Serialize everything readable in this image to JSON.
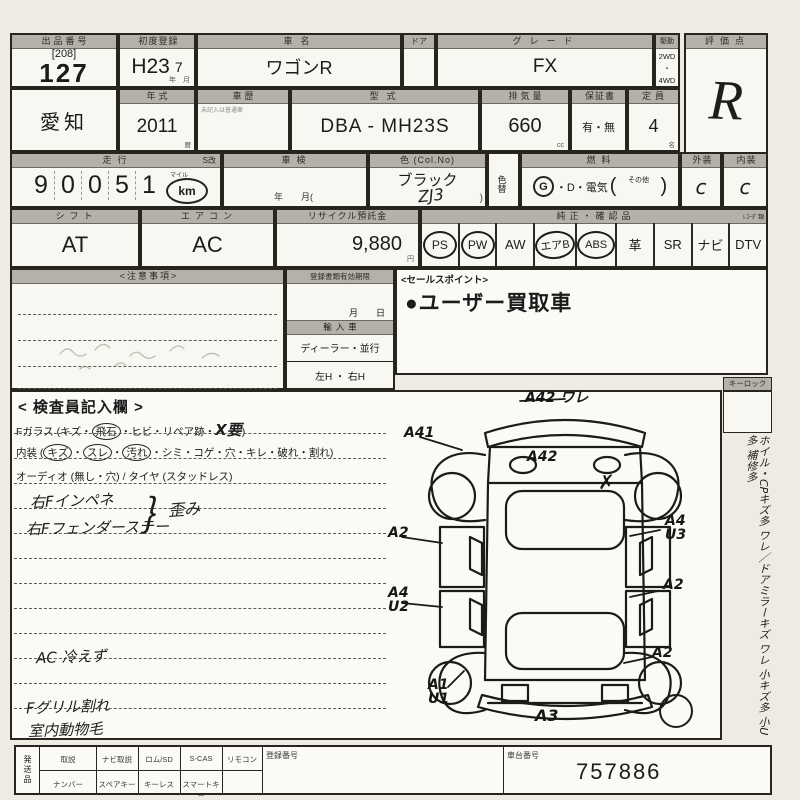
{
  "row1": {
    "lot_header": "出品番号",
    "lot_bracket": "[208]",
    "lot_number": "127",
    "first_reg_header": "初度登録",
    "first_reg": "H23",
    "first_reg_month": "7",
    "first_reg_units": "年　月",
    "car_name_header": "車名",
    "car_name": "ワゴンR",
    "door_header": "ドア",
    "grade_header": "グレード",
    "grade": "FX",
    "drive_header": "駆動",
    "drive_top": "2WD",
    "drive_dot": "・",
    "drive_bottom": "4WD",
    "score_header": "評価点",
    "score": "R"
  },
  "row2": {
    "prefecture": "愛知",
    "year_header": "年式",
    "year": "2011",
    "year_unit": "暦",
    "history_header": "車歴",
    "history_note": "未記入は普通車",
    "model_header": "型式",
    "model": "DBA - MH23S",
    "displacement_header": "排気量",
    "displacement": "660",
    "displacement_unit": "cc",
    "warranty_header": "保証書",
    "warranty": "有・無",
    "capacity_header": "定員",
    "capacity": "4",
    "capacity_unit": "名"
  },
  "row3": {
    "mileage_header": "走行",
    "s_header": "S改",
    "mileage_digits": [
      "9",
      "0",
      "0",
      "5",
      "1"
    ],
    "mileage_mile_label": "マイル",
    "mileage_unit": "km",
    "inspection_header": "車検",
    "inspection_units": "年　　月(",
    "color_header": "色 (Col.No)",
    "color": "ブラック",
    "color_code": "ZJ3",
    "color_paren": ")",
    "color_change_header": "色替",
    "fuel_header": "燃料",
    "fuel_g": "G",
    "fuel_rest": "・D・電気",
    "fuel_paren_open": "(",
    "fuel_other": "その他",
    "fuel_paren_close": ")",
    "exterior_header": "外装",
    "exterior": "c",
    "interior_header": "内装",
    "interior": "c"
  },
  "row4": {
    "shift_header": "シフト",
    "shift": "AT",
    "aircon_header": "エアコン",
    "aircon": "AC",
    "recycle_header": "リサイクル預託金",
    "recycle": "9,880",
    "recycle_unit": "円",
    "equipment_header": "純正・確認品",
    "equipment_note": "ﾚｺｰﾀﾞ類",
    "equipment": [
      {
        "label": "PS",
        "circled": true
      },
      {
        "label": "PW",
        "circled": true
      },
      {
        "label": "AW",
        "circled": false
      },
      {
        "label": "エアB",
        "circled": true
      },
      {
        "label": "ABS",
        "circled": true
      },
      {
        "label": "革",
        "circled": false
      },
      {
        "label": "SR",
        "circled": false
      },
      {
        "label": "ナビ",
        "circled": false
      },
      {
        "label": "DTV",
        "circled": false
      }
    ]
  },
  "notes": {
    "notice_header": "<注意事項>",
    "doc_header": "登録書類有効期限",
    "doc_units": "月　　日",
    "import_header": "輸入車",
    "import_type": "ディーラー・並行",
    "import_handle": "左H ・ 右H",
    "sales_header": "<セールスポイント>",
    "sales_point": "●ユーザー買取車",
    "keylock_label": "キーロック"
  },
  "inspector": {
    "title": "< 検査員記入欄 >",
    "glass_prefix": "Fガラス (キズ・",
    "glass_circled": "飛石",
    "glass_mid": "・ヒビ・リペア跡・",
    "glass_hand": "X要",
    "glass_suffix": ")",
    "interior_prefix": "内装 (",
    "interior_c1": "キズ",
    "interior_sep1": "・",
    "interior_c2": "スレ",
    "interior_sep2": "・",
    "interior_c3": "汚れ",
    "interior_rest": "・シミ・コゲ・穴・キレ・破れ・割れ)",
    "audio_line": "オーディオ (無し・穴) / タイヤ (スタッドレス)",
    "hand_note1": "右Fインペネ",
    "hand_note2": "右Fフェンダーステー",
    "hand_brace": "｝",
    "hand_brace_label": "歪み",
    "hand_note3": "AC 冷えず",
    "hand_note4": "Fグリル割れ",
    "hand_note5": "室内動物毛"
  },
  "diagram": {
    "codes": [
      "A42 ワレ",
      "A41",
      "A42",
      "✗",
      "A2",
      "A4\nU3",
      "A4\nU2",
      "A2",
      "A2",
      "A1\nU1",
      "A3"
    ]
  },
  "sidebar": {
    "vertical_note": "ホイル・CPキズ多 ワレ／ドアミラーキズ ワレ 小キズ多 小U多 補修多"
  },
  "bottom": {
    "ship_label": "発送品",
    "row1_labels": [
      "取説",
      "ナビ取説",
      "ロム/SD",
      "S-CAS",
      "リモコン"
    ],
    "row2_labels": [
      "ナンバー",
      "スペアキー",
      "キーレス",
      "スマートキー"
    ],
    "reg_header": "登録番号",
    "chassis_header": "車台番号",
    "chassis": "757886"
  }
}
